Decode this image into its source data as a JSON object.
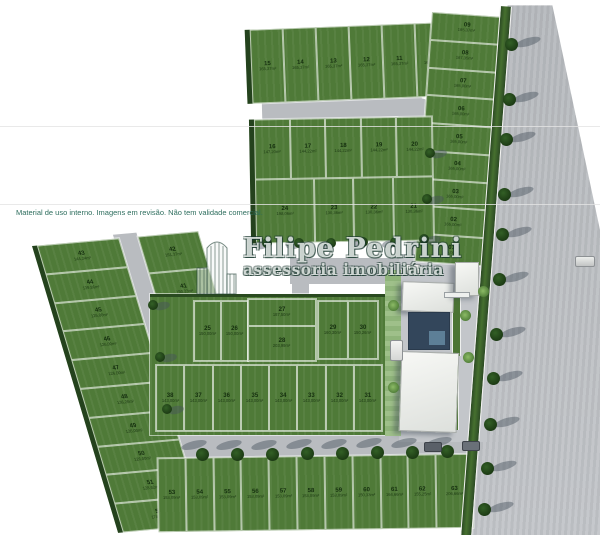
{
  "disclaimer": "Material de uso interno. Imagens em revisão. Não tem validade comercial.",
  "watermark": {
    "title": "Filipe Pedrini",
    "subtitle": "assessoria imobiliária"
  },
  "colors": {
    "grass": "#4f7a38",
    "hedge": "#24421d",
    "road": "#b9bcc0",
    "pool": "#33465b",
    "watermark_outline": "#1a382e",
    "disclaimer_text": "#2e6e5e"
  },
  "blocks": {
    "top_row": [
      {
        "n": "15",
        "a": "165,37m²"
      },
      {
        "n": "14",
        "a": "165,37m²"
      },
      {
        "n": "13",
        "a": "165,37m²"
      },
      {
        "n": "12",
        "a": "165,37m²"
      },
      {
        "n": "11",
        "a": "165,37m²"
      },
      {
        "n": "10",
        "a": "165,37m²"
      }
    ],
    "right_column": [
      {
        "n": "09",
        "a": "165,37m²"
      },
      {
        "n": "08",
        "a": "167,35m²"
      },
      {
        "n": "07",
        "a": "165,00m²"
      },
      {
        "n": "06",
        "a": "165,00m²"
      },
      {
        "n": "05",
        "a": "165,00m²"
      },
      {
        "n": "04",
        "a": "165,00m²"
      },
      {
        "n": "03",
        "a": "165,00m²"
      },
      {
        "n": "02",
        "a": "165,00m²"
      },
      {
        "n": "01",
        "a": "165,00m²"
      }
    ],
    "mid_upper_row": [
      {
        "n": "16",
        "a": "147,20m²"
      },
      {
        "n": "17",
        "a": "144,22m²"
      },
      {
        "n": "18",
        "a": "144,22m²"
      },
      {
        "n": "19",
        "a": "144,22m²"
      },
      {
        "n": "20",
        "a": "144,22m²"
      }
    ],
    "mid_lower_row": [
      {
        "n": "24",
        "a": "198,06m²",
        "f": "1.5"
      },
      {
        "n": "23",
        "a": "130,36m²"
      },
      {
        "n": "22",
        "a": "130,36m²"
      },
      {
        "n": "21",
        "a": "130,36m²"
      }
    ],
    "central_25_26": [
      {
        "n": "25",
        "a": "150,00m²"
      },
      {
        "n": "26",
        "a": "150,00m²"
      }
    ],
    "central_27_28": [
      {
        "n": "27",
        "a": "187,50m²"
      },
      {
        "n": "28",
        "a": "203,99m²"
      }
    ],
    "central_29_30": [
      {
        "n": "29",
        "a": "160,30m²"
      },
      {
        "n": "30",
        "a": "150,26m²"
      }
    ],
    "central_bottom_row": [
      {
        "n": "38",
        "a": "143,00m²"
      },
      {
        "n": "37",
        "a": "143,00m²"
      },
      {
        "n": "36",
        "a": "143,00m²"
      },
      {
        "n": "35",
        "a": "143,00m²"
      },
      {
        "n": "34",
        "a": "143,00m²"
      },
      {
        "n": "33",
        "a": "143,00m²"
      },
      {
        "n": "32",
        "a": "143,00m²"
      },
      {
        "n": "31",
        "a": "143,00m²"
      }
    ],
    "left_column_a": [
      {
        "n": "43",
        "a": "144,24m²"
      },
      {
        "n": "44",
        "a": "139,86m²"
      },
      {
        "n": "45",
        "a": "126,00m²"
      },
      {
        "n": "46",
        "a": "126,00m²"
      },
      {
        "n": "47",
        "a": "126,00m²"
      },
      {
        "n": "48",
        "a": "136,26m²"
      },
      {
        "n": "49",
        "a": "126,00m²"
      },
      {
        "n": "50",
        "a": "126,00m²"
      },
      {
        "n": "51",
        "a": "128,62m²"
      },
      {
        "n": "52",
        "a": "174,86m²"
      }
    ],
    "left_column_b": [
      {
        "n": "42",
        "a": "161,37m²"
      },
      {
        "n": "41",
        "a": "150,23m²"
      },
      {
        "n": "40",
        "a": "162,37m²"
      },
      {
        "n": "39",
        "a": "162,37m²"
      }
    ],
    "bottom_row": [
      {
        "n": "53",
        "a": "153,09m²"
      },
      {
        "n": "54",
        "a": "153,09m²"
      },
      {
        "n": "55",
        "a": "153,09m²"
      },
      {
        "n": "56",
        "a": "153,09m²"
      },
      {
        "n": "57",
        "a": "153,09m²"
      },
      {
        "n": "58",
        "a": "153,09m²"
      },
      {
        "n": "59",
        "a": "153,09m²"
      },
      {
        "n": "60",
        "a": "150,33m²"
      },
      {
        "n": "61",
        "a": "164,66m²"
      },
      {
        "n": "62",
        "a": "155,25m²"
      },
      {
        "n": "63",
        "a": "206,66m²",
        "f": "1.35"
      }
    ]
  }
}
